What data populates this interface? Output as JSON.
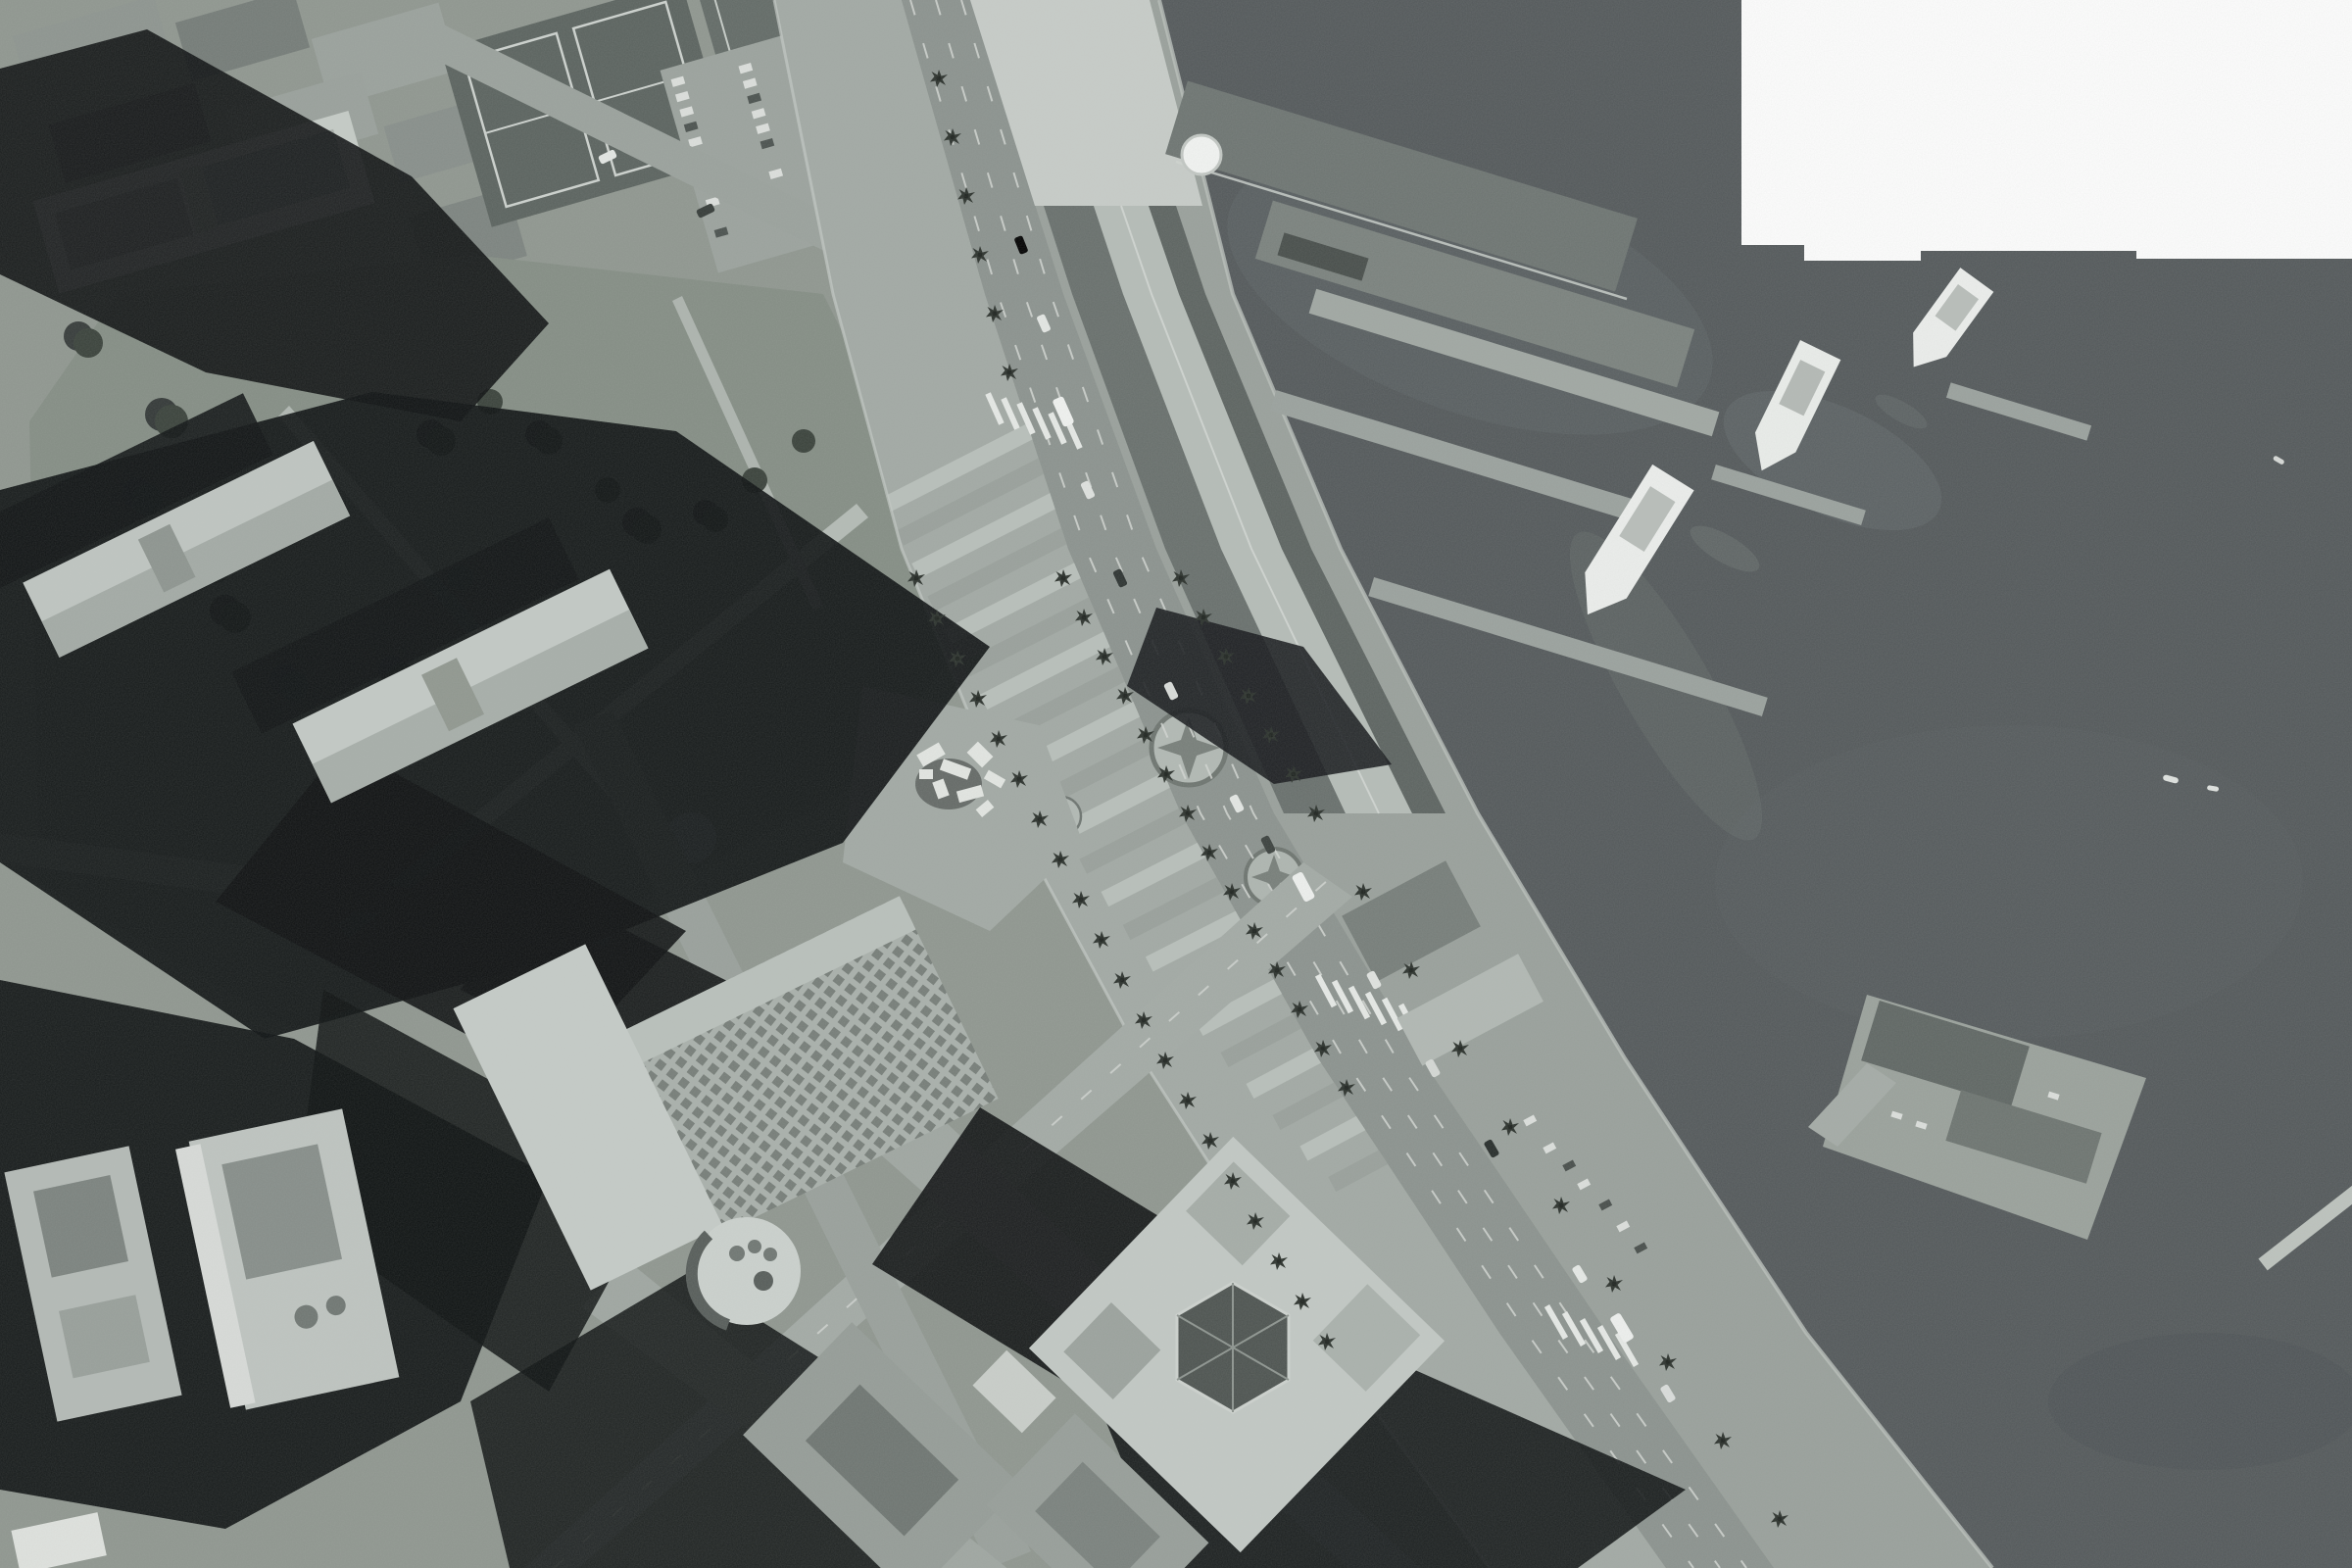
{
  "scene": {
    "title": "Grayscale aerial orthophoto — San Francisco Embarcadero waterfront",
    "description": "Vertical black-and-white aerial photograph. The Embarcadero boulevard curves diagonally from top-center to bottom-right, flanked by a striped palm-lined promenade and the long Ferry Building pier sheds. Dark bay water fills the upper-right and right side with ferries docked at finger piers; a white missing-imagery rectangle sits in the top-right corner. Upper-left: tennis courts, parking lot, apartment blocks and a tree-filled park lawn crossed by light paths under a huge black tower shadow. Lower-left: downtown blocks, Embarcadero Center slabs, the Hyatt terraced roof with circular top, a diamond-oriented tower with hexagonal atrium, and long black building shadows pointing northwest.",
    "image_type": "aerial orthophoto",
    "color_mode": "grayscale",
    "visible_text": "none"
  },
  "landmarks": [
    {
      "id": "embarcadero-boulevard",
      "label": "Embarcadero boulevard with median and lane dashes"
    },
    {
      "id": "promenade-stripes",
      "label": "Striped pedestrian promenade with twin compass-rose motifs"
    },
    {
      "id": "ferry-building-sheds",
      "label": "Ferry Building long parallel pier sheds"
    },
    {
      "id": "pier-1",
      "label": "Pier 1 sheds with white dome tank"
    },
    {
      "id": "ferry-basin",
      "label": "Ferry terminal basin with finger docks and three white ferries"
    },
    {
      "id": "pier-14",
      "label": "South pier deck with two shed roofs"
    },
    {
      "id": "sue-bierman-park",
      "label": "Park lawn, tree clusters and diagonal paths"
    },
    {
      "id": "justin-herman-plaza",
      "label": "Plaza with jumbled white fountain blocks"
    },
    {
      "id": "hyatt-regency",
      "label": "Terraced waffle roof with circular rooftop"
    },
    {
      "id": "embarcadero-center",
      "label": "Long bright office slabs with black NW shadows"
    },
    {
      "id": "diamond-tower",
      "label": "45-degree bright block with hexagonal glass atrium"
    },
    {
      "id": "tennis-courts",
      "label": "Tennis courts and car-filled parking lot"
    },
    {
      "id": "missing-tile",
      "label": "White missing-imagery rectangle, top-right"
    },
    {
      "id": "bay-water",
      "label": "Dark bay water with sediment swirls and small boats"
    }
  ],
  "palette": {
    "water": "#53585a",
    "land_base": "#8f968f",
    "road": "#8b928e",
    "promenade": "#a2a9a4",
    "stripe_light": "#b8bfba",
    "stripe_mid": "#99a09b",
    "roof_bright": "#c7ccc8",
    "roof_dark": "#686f6c",
    "shadow": "#0d1011",
    "lawn": "#848d84",
    "tree": "#39413a",
    "missing_tile": "#fdfdfd",
    "ferry_hull": "#eceeec"
  },
  "objects": {
    "ferries": 3,
    "small_boats": 3,
    "compass_rose_motifs": 2,
    "tennis_courts": 3,
    "missing_tiles": 1,
    "palm_rows": 4
  }
}
